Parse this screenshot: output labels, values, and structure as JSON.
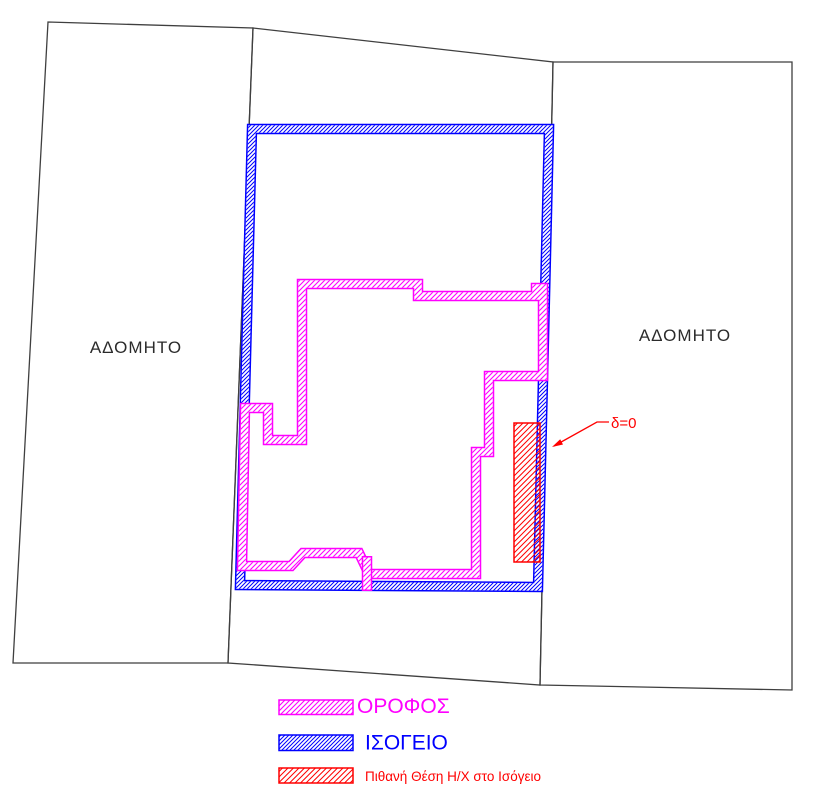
{
  "parcels": {
    "left_label": "ΑΔΟΜΗΤΟ",
    "right_label": "ΑΔΟΜΗΤΟ"
  },
  "annotation": {
    "delta_label": "δ=0"
  },
  "legend": {
    "items": [
      {
        "label": "ΟΡΟΦΟΣ",
        "color": "#ff00ff"
      },
      {
        "label": "ΙΣΟΓΕΙΟ",
        "color": "#0000ff"
      },
      {
        "label": "Πιθανή Θέση Η/Χ στο Ισόγειο",
        "color": "#ff0000"
      }
    ]
  },
  "colors": {
    "upper_floor": "#ff00ff",
    "ground_floor": "#0000ff",
    "hx_zone": "#ff0000",
    "parcel_line": "#3f3f3f"
  }
}
